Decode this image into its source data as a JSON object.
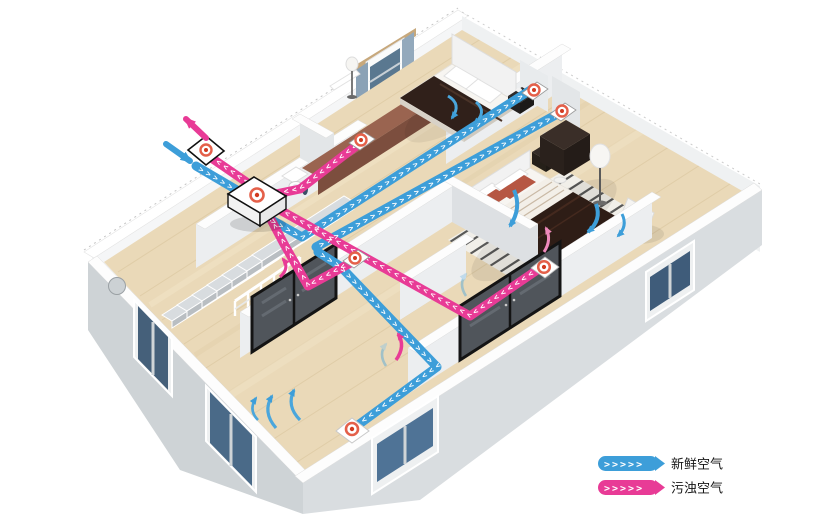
{
  "legend": {
    "items": [
      {
        "id": "fresh-air",
        "label": "新鲜空气",
        "chevrons": ">>>>>",
        "color": "#3D9ED9"
      },
      {
        "id": "exhaust-air",
        "label": "污浊空气",
        "chevrons": ">>>>>",
        "color": "#E83B96"
      }
    ]
  },
  "ducts": {
    "chevrons": ">>>>>>>>>>>>>>>>>>>>>>>>>>>>>>>>>>>>>>>>>>>>>>>>>>>>>>>>>>>>>>>>"
  },
  "colors": {
    "fresh_air_duct": "#3D9ED9",
    "exhaust_air_duct": "#E83B96",
    "diffuser_ring": "#E4604A",
    "diffuser_dot": "#D13A20",
    "floor_wood": "#EAD9B8",
    "outer_wall": "#CED3D6",
    "inner_wall": "#ECEEF0",
    "window_glass": "#4F7396",
    "curtain": "#8BA2B6",
    "bed_duvet": "#2E1D16"
  }
}
